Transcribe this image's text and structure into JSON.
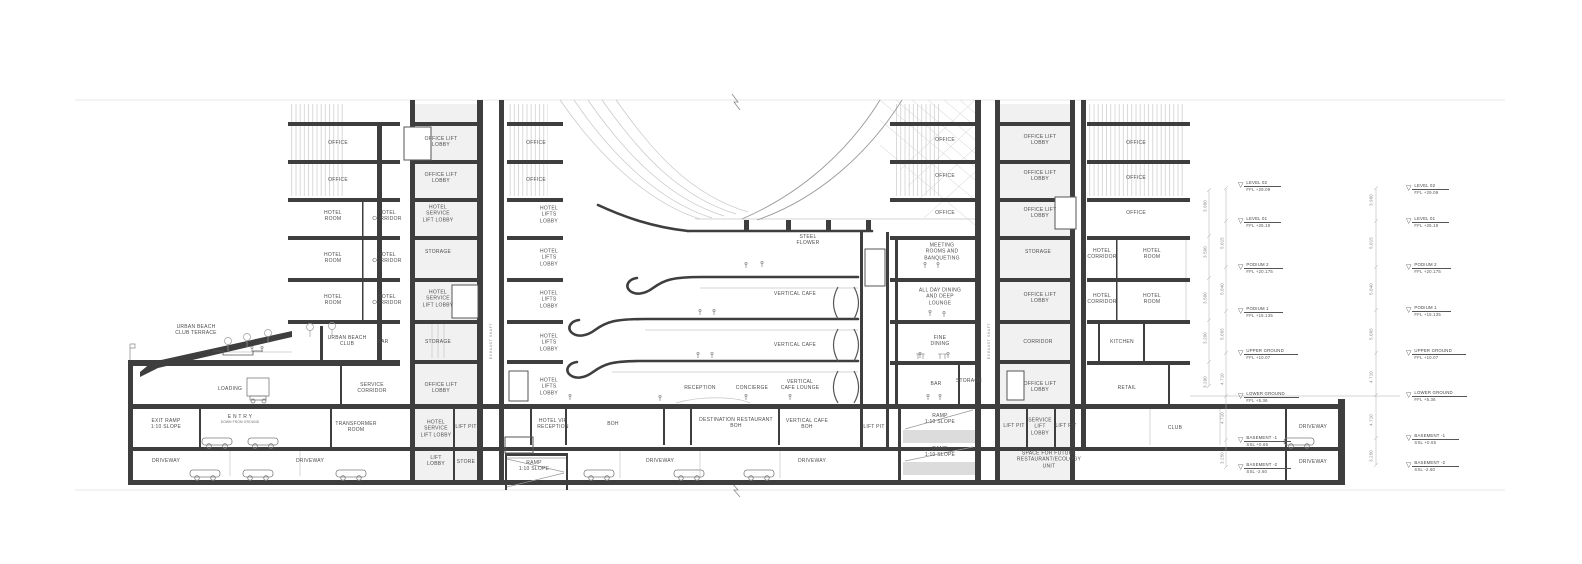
{
  "drawing": {
    "type": "architectural-building-section"
  },
  "labels": [
    {
      "t": "OFFICE",
      "x": 338,
      "y": 143
    },
    {
      "t": "OFFICE",
      "x": 338,
      "y": 180
    },
    {
      "t": "HOTEL\nROOM",
      "x": 333,
      "y": 216
    },
    {
      "t": "HOTEL\nCORRIDOR",
      "x": 387,
      "y": 216
    },
    {
      "t": "HOTEL\nROOM",
      "x": 333,
      "y": 258
    },
    {
      "t": "HOTEL\nCORRIDOR",
      "x": 387,
      "y": 258
    },
    {
      "t": "HOTEL\nROOM",
      "x": 333,
      "y": 300
    },
    {
      "t": "HOTEL\nCORRIDOR",
      "x": 387,
      "y": 300
    },
    {
      "t": "URBAN BEACH\nCLUB",
      "x": 347,
      "y": 341
    },
    {
      "t": "BAR",
      "x": 383,
      "y": 342
    },
    {
      "t": "URBAN BEACH\nCLUB TERRACE",
      "x": 196,
      "y": 330
    },
    {
      "t": "LOADING",
      "x": 230,
      "y": 389
    },
    {
      "t": "SERVICE\nCORRIDOR",
      "x": 372,
      "y": 388
    },
    {
      "t": "EXIT RAMP\n1:10 SLOPE",
      "x": 166,
      "y": 424
    },
    {
      "t": "E N T R Y",
      "s": "DOWN FROM GROUND",
      "x": 240,
      "y": 419
    },
    {
      "t": "TRANSFORMER\nROOM",
      "x": 356,
      "y": 427
    },
    {
      "t": "DRIVEWAY",
      "x": 166,
      "y": 461
    },
    {
      "t": "DRIVEWAY",
      "x": 310,
      "y": 461
    },
    {
      "t": "OFFICE LIFT\nLOBBY",
      "x": 441,
      "y": 142
    },
    {
      "t": "OFFICE LIFT\nLOBBY",
      "x": 441,
      "y": 178
    },
    {
      "t": "HOTEL\nSERVICE\nLIFT LOBBY",
      "x": 438,
      "y": 214
    },
    {
      "t": "STORAGE",
      "x": 438,
      "y": 252
    },
    {
      "t": "HOTEL\nSERVICE\nLIFT LOBBY",
      "x": 438,
      "y": 299
    },
    {
      "t": "STORAGE",
      "x": 438,
      "y": 342
    },
    {
      "t": "OFFICE LIFT\nLOBBY",
      "x": 441,
      "y": 388
    },
    {
      "t": "HOTEL\nSERVICE\nLIFT LOBBY",
      "x": 436,
      "y": 429
    },
    {
      "t": "LIFT PIT",
      "x": 466,
      "y": 427
    },
    {
      "t": "LIFT\nLOBBY",
      "x": 436,
      "y": 461
    },
    {
      "t": "STORE",
      "x": 466,
      "y": 462
    },
    {
      "t": "OFFICE",
      "x": 536,
      "y": 143
    },
    {
      "t": "OFFICE",
      "x": 536,
      "y": 180
    },
    {
      "t": "HOTEL\nLIFTS\nLOBBY",
      "x": 549,
      "y": 215
    },
    {
      "t": "HOTEL\nLIFTS\nLOBBY",
      "x": 549,
      "y": 258
    },
    {
      "t": "HOTEL\nLIFTS\nLOBBY",
      "x": 549,
      "y": 300
    },
    {
      "t": "HOTEL\nLIFTS\nLOBBY",
      "x": 549,
      "y": 343
    },
    {
      "t": "HOTEL\nLIFTS\nLOBBY",
      "x": 549,
      "y": 387
    },
    {
      "t": "HOTEL VIP\nRECEPTION",
      "x": 553,
      "y": 424
    },
    {
      "t": "RAMP\n1:10 SLOPE",
      "x": 534,
      "y": 466
    },
    {
      "t": "STEEL\nFLOWER",
      "x": 808,
      "y": 240
    },
    {
      "t": "VERTICAL CAFE",
      "x": 795,
      "y": 294
    },
    {
      "t": "VERTICAL CAFE",
      "x": 795,
      "y": 345
    },
    {
      "t": "VERTICAL\nCAFE LOUNGE",
      "x": 800,
      "y": 385
    },
    {
      "t": "CONCIERGE",
      "x": 752,
      "y": 388
    },
    {
      "t": "RECEPTION",
      "x": 700,
      "y": 388
    },
    {
      "t": "BOH",
      "x": 613,
      "y": 424
    },
    {
      "t": "DESTINATION RESTAURANT\nBOH",
      "x": 736,
      "y": 423
    },
    {
      "t": "VERTICAL CAFE\nBOH",
      "x": 807,
      "y": 424
    },
    {
      "t": "LIFT PIT",
      "x": 874,
      "y": 427
    },
    {
      "t": "RAMP\n1:10 SLOPE",
      "x": 940,
      "y": 419
    },
    {
      "t": "RAMP\n1:10 SLOPE",
      "x": 940,
      "y": 452
    },
    {
      "t": "DRIVEWAY",
      "x": 660,
      "y": 461
    },
    {
      "t": "DRIVEWAY",
      "x": 812,
      "y": 461
    },
    {
      "t": "OFFICE",
      "x": 945,
      "y": 140
    },
    {
      "t": "OFFICE",
      "x": 945,
      "y": 176
    },
    {
      "t": "OFFICE",
      "x": 945,
      "y": 213
    },
    {
      "t": "MEETING\nROOMS AND\nBANQUETING",
      "x": 942,
      "y": 252
    },
    {
      "t": "ALL DAY DINING\nAND DEEP\nLOUNGE",
      "x": 940,
      "y": 297
    },
    {
      "t": "FINE\nDINING",
      "x": 940,
      "y": 341
    },
    {
      "t": "BAR",
      "x": 936,
      "y": 384
    },
    {
      "t": "STORAGE",
      "x": 969,
      "y": 381
    },
    {
      "t": "OFFICE LIFT\nLOBBY",
      "x": 1040,
      "y": 140
    },
    {
      "t": "OFFICE LIFT\nLOBBY",
      "x": 1040,
      "y": 176
    },
    {
      "t": "OFFICE LIFT\nLOBBY",
      "x": 1040,
      "y": 213
    },
    {
      "t": "STORAGE",
      "x": 1038,
      "y": 252
    },
    {
      "t": "OFFICE LIFT\nLOBBY",
      "x": 1040,
      "y": 298
    },
    {
      "t": "CORRIDOR",
      "x": 1038,
      "y": 342
    },
    {
      "t": "OFFICE LIFT\nLOBBY",
      "x": 1040,
      "y": 387
    },
    {
      "t": "LIFT PIT",
      "x": 1014,
      "y": 426
    },
    {
      "t": "SERVICE\nLIFT\nLOBBY",
      "x": 1040,
      "y": 427
    },
    {
      "t": "LIFT PIT",
      "x": 1066,
      "y": 426
    },
    {
      "t": "SPACE FOR FUTURE\nRESTAURANT/ECOLOGY\nUNIT",
      "x": 1049,
      "y": 460
    },
    {
      "t": "OFFICE",
      "x": 1136,
      "y": 143
    },
    {
      "t": "OFFICE",
      "x": 1136,
      "y": 178
    },
    {
      "t": "OFFICE",
      "x": 1136,
      "y": 213
    },
    {
      "t": "HOTEL\nCORRIDOR",
      "x": 1102,
      "y": 254
    },
    {
      "t": "HOTEL\nROOM",
      "x": 1152,
      "y": 254
    },
    {
      "t": "HOTEL\nCORRIDOR",
      "x": 1102,
      "y": 299
    },
    {
      "t": "HOTEL\nROOM",
      "x": 1152,
      "y": 299
    },
    {
      "t": "KITCHEN",
      "x": 1122,
      "y": 342
    },
    {
      "t": "RETAIL",
      "x": 1127,
      "y": 388
    },
    {
      "t": "CLUB",
      "x": 1175,
      "y": 428
    },
    {
      "t": "DRIVEWAY",
      "x": 1313,
      "y": 427
    },
    {
      "t": "DRIVEWAY",
      "x": 1313,
      "y": 462
    }
  ],
  "vlabels": [
    {
      "t": "EXHAUST SHAFT",
      "x": 491,
      "y": 341
    },
    {
      "t": "EXHAUST SHAFT",
      "x": 989,
      "y": 341
    }
  ],
  "levels": [
    {
      "name": "LEVEL 02",
      "val": "FFL +29.09"
    },
    {
      "name": "LEVEL 01",
      "val": "FFL +25.19"
    },
    {
      "name": "PODIUM 2",
      "val": "FFL +20.175"
    },
    {
      "name": "PODIUM 1",
      "val": "FFL +15.135"
    },
    {
      "name": "UPPER GROUND",
      "val": "FFL +10.07"
    },
    {
      "name": "LOWER GROUND",
      "val": "FFL +5.36"
    },
    {
      "name": "BASEMENT -1",
      "val": "SSL +0.65"
    },
    {
      "name": "BASEMENT -2",
      "val": "SSL -2.60"
    }
  ],
  "level_columns": [
    {
      "x": 1238,
      "ys": [
        185,
        221,
        267,
        311,
        353,
        396,
        440,
        467
      ]
    },
    {
      "x": 1406,
      "ys": [
        188,
        221,
        267,
        310,
        353,
        395,
        438,
        465
      ]
    }
  ],
  "dim_columns": [
    {
      "x": 1205,
      "items": [
        [
          "3.900",
          206
        ],
        [
          "3.500",
          252
        ],
        [
          "3.500",
          298
        ],
        [
          "3.200",
          338
        ],
        [
          "3.200",
          382
        ]
      ]
    },
    {
      "x": 1222,
      "items": [
        [
          "5.015",
          243
        ],
        [
          "5.040",
          289
        ],
        [
          "5.065",
          334
        ],
        [
          "4.710",
          379
        ],
        [
          "4.710",
          418
        ],
        [
          "3.250",
          458
        ]
      ]
    },
    {
      "x": 1371,
      "items": [
        [
          "3.900",
          200
        ],
        [
          "5.015",
          243
        ],
        [
          "5.040",
          289
        ],
        [
          "5.065",
          334
        ],
        [
          "4.710",
          377
        ],
        [
          "4.710",
          420
        ],
        [
          "3.250",
          456
        ]
      ]
    }
  ]
}
